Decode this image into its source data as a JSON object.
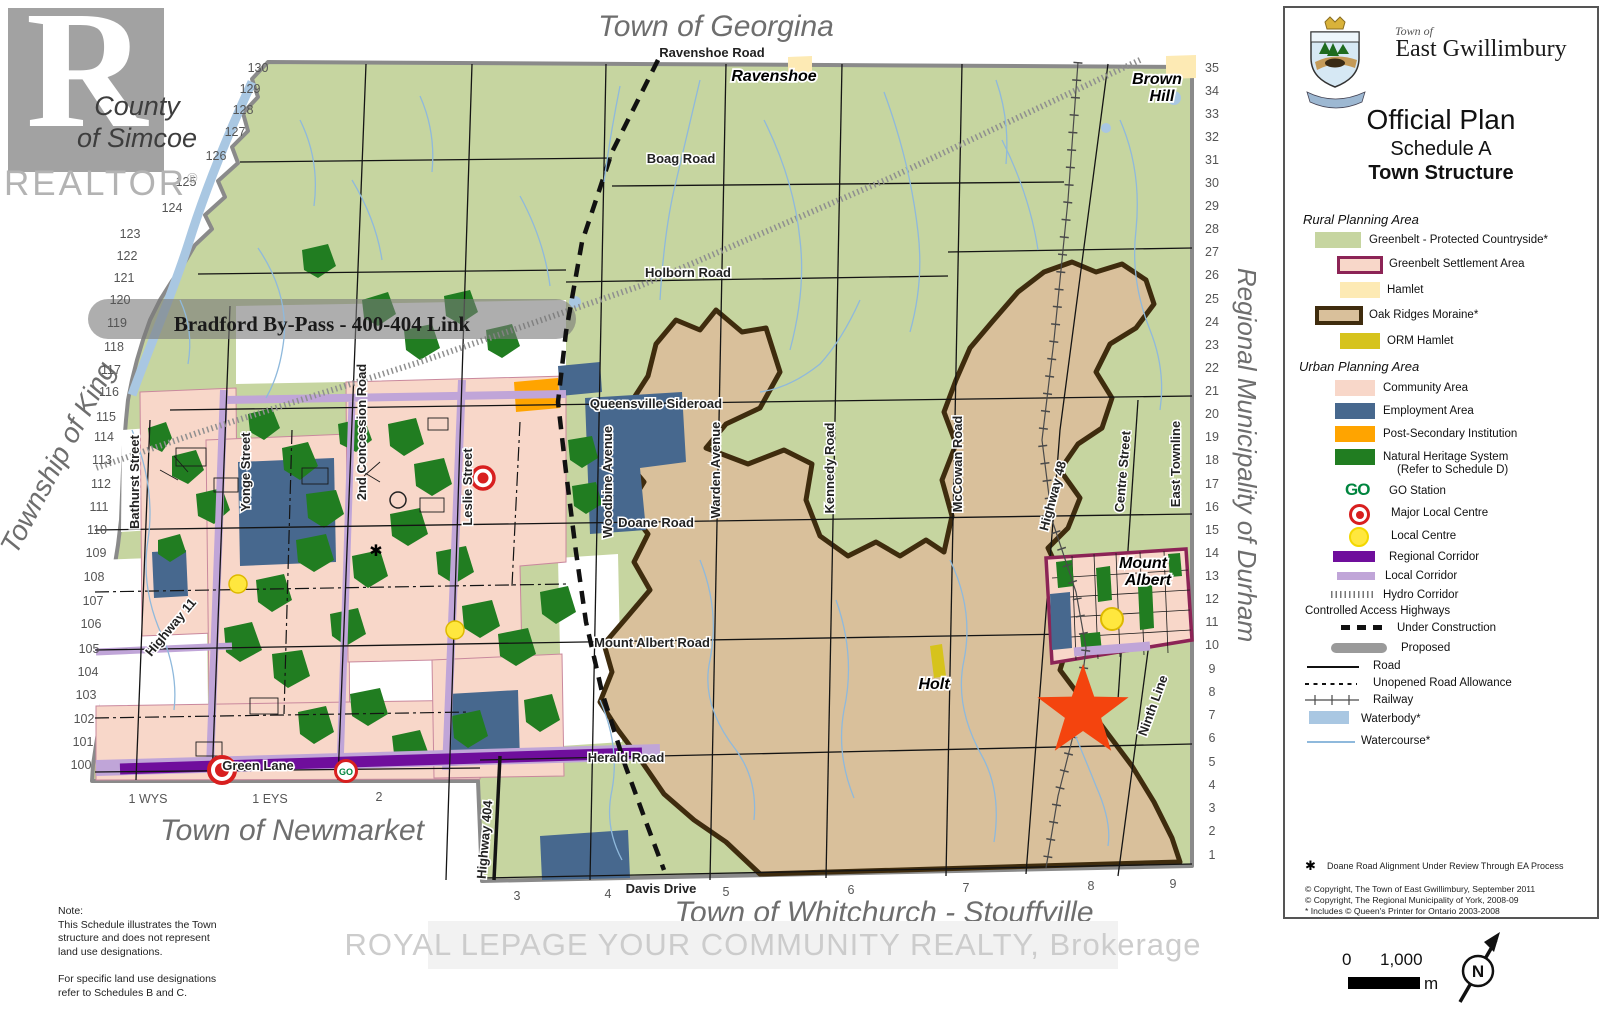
{
  "watermarks": {
    "r_letter": "R",
    "county_line1": "County",
    "county_line2": "of Simcoe",
    "realtor": "REALTOR",
    "registered": "®",
    "brokerage": "ROYAL LEPAGE YOUR COMMUNITY REALTY, Brokerage"
  },
  "title_block": {
    "town_of": "Town of",
    "town_name": "East Gwillimbury",
    "plan": "Official Plan",
    "schedule": "Schedule A",
    "structure": "Town Structure"
  },
  "legend": {
    "rural_header": "Rural Planning Area",
    "rural": [
      {
        "label": "Greenbelt - Protected Countryside*"
      },
      {
        "label": "Greenbelt Settlement Area"
      },
      {
        "label": "Hamlet"
      },
      {
        "label": "Oak Ridges Moraine*"
      },
      {
        "label": "ORM Hamlet"
      }
    ],
    "urban_header": "Urban Planning Area",
    "urban": [
      {
        "label": "Community Area"
      },
      {
        "label": "Employment Area"
      },
      {
        "label": "Post-Secondary Institution"
      },
      {
        "label": "Natural Heritage System",
        "label2": "(Refer to Schedule D)"
      }
    ],
    "symbols": {
      "go_text": "GO",
      "go_station": "GO Station",
      "major": "Major Local Centre",
      "local": "Local Centre",
      "regional_corridor": "Regional Corridor",
      "local_corridor": "Local Corridor",
      "hydro": "Hydro Corridor",
      "cah_header": "Controlled Access Highways",
      "under_construction": "Under Construction",
      "proposed": "Proposed",
      "road": "Road",
      "unopened": "Unopened Road Allowance",
      "railway": "Railway",
      "waterbody": "Waterbody*",
      "watercourse": "Watercourse*"
    },
    "footnote_star": "✱",
    "footnote": "Doane Road Alignment Under Review Through EA Process",
    "copyright1": "© Copyright, The Town of East Gwillimbury, September 2011",
    "copyright2": "© Copyright, The Regional Municipality of York, 2008-09",
    "copyright3": "* Includes © Queen's Printer for Ontario 2003-2008"
  },
  "notes": {
    "text": "Note:\nThis Schedule illustrates the Town\nstructure and does not represent\nland use designations.\n\nFor specific land use designations\nrefer to Schedules B and C."
  },
  "scale": {
    "zero": "0",
    "distance": "1,000",
    "unit": "m",
    "north": "N"
  },
  "colors": {
    "greenbelt": "#c6d5a0",
    "orm": "#d9c09b",
    "community": "#f8d7c9",
    "employment": "#47688e",
    "post_secondary": "#ffa400",
    "nhs": "#217d21",
    "hamlet": "#fdeab4",
    "orm_hamlet": "#d6c31c",
    "regional_corridor": "#6f0e9c",
    "local_corridor": "#c0a5d8",
    "waterbody": "#a9c7e2",
    "go_green": "#00853f",
    "centre_red": "#d81f1f",
    "local_yellow": "#ffe73e",
    "star": "#f4440e"
  },
  "map_labels": [
    {
      "t": "Town of Georgina",
      "x": 716,
      "y": 36,
      "r": 0,
      "c": "muni"
    },
    {
      "t": "Township of King",
      "x": 66,
      "y": 462,
      "r": -62,
      "c": "muni muni-k"
    },
    {
      "t": "Regional Municipality of Durham",
      "x": 1238,
      "y": 455,
      "r": 90,
      "c": "muni muni-v"
    },
    {
      "t": "Town of Newmarket",
      "x": 292,
      "y": 840,
      "r": 0,
      "c": "muni"
    },
    {
      "t": "Town of Whitchurch - Stouffville",
      "x": 884,
      "y": 922,
      "r": 0,
      "c": "muni"
    },
    {
      "t": "Ravenshoe Road",
      "x": 712,
      "y": 57,
      "r": 0,
      "c": "road-h"
    },
    {
      "t": "Boag Road",
      "x": 681,
      "y": 163,
      "r": 0,
      "c": "road-h"
    },
    {
      "t": "Holborn Road",
      "x": 688,
      "y": 277,
      "r": 0,
      "c": "road-h"
    },
    {
      "t": "Queensville Sideroad",
      "x": 656,
      "y": 408,
      "r": 0,
      "c": "road-h"
    },
    {
      "t": "Doane Road",
      "x": 656,
      "y": 527,
      "r": 0,
      "c": "road-h"
    },
    {
      "t": "Mount Albert Road",
      "x": 652,
      "y": 647,
      "r": 0,
      "c": "road-h"
    },
    {
      "t": "Herald Road",
      "x": 626,
      "y": 762,
      "r": 0,
      "c": "road-h"
    },
    {
      "t": "Green Lane",
      "x": 258,
      "y": 770,
      "r": 0,
      "c": "road-h"
    },
    {
      "t": "Davis Drive",
      "x": 661,
      "y": 893,
      "r": 0,
      "c": "road-h"
    },
    {
      "t": "Bathurst Street",
      "x": 139,
      "y": 482,
      "r": -90,
      "c": "road-v"
    },
    {
      "t": "Yonge Street",
      "x": 250,
      "y": 472,
      "r": -90,
      "c": "road-v"
    },
    {
      "t": "2nd Concession Road",
      "x": 366,
      "y": 432,
      "r": -90,
      "c": "road-v"
    },
    {
      "t": "Leslie Street",
      "x": 472,
      "y": 487,
      "r": -90,
      "c": "road-v"
    },
    {
      "t": "Woodbine Avenue",
      "x": 612,
      "y": 482,
      "r": -90,
      "c": "road-v"
    },
    {
      "t": "Warden Avenue",
      "x": 720,
      "y": 470,
      "r": -90,
      "c": "road-v"
    },
    {
      "t": "Kennedy Road",
      "x": 834,
      "y": 468,
      "r": -90,
      "c": "road-v"
    },
    {
      "t": "McCowan Road",
      "x": 962,
      "y": 464,
      "r": -90,
      "c": "road-v"
    },
    {
      "t": "Highway 48",
      "x": 1057,
      "y": 497,
      "r": -75,
      "c": "road-v"
    },
    {
      "t": "Centre Street",
      "x": 1127,
      "y": 472,
      "r": -85,
      "c": "road-v"
    },
    {
      "t": "East Townline",
      "x": 1180,
      "y": 464,
      "r": -90,
      "c": "road-v"
    },
    {
      "t": "Ninth Line",
      "x": 1157,
      "y": 707,
      "r": -70,
      "c": "road-v"
    },
    {
      "t": "Highway 404",
      "x": 489,
      "y": 840,
      "r": -85,
      "c": "road-v"
    },
    {
      "t": "Highway 11",
      "x": 174,
      "y": 630,
      "r": -50,
      "c": "road-v"
    },
    {
      "t": "Ravenshoe",
      "x": 774,
      "y": 81,
      "r": 0,
      "c": "place"
    },
    {
      "t": "Brown",
      "x": 1157,
      "y": 84,
      "r": 0,
      "c": "place"
    },
    {
      "t": "Hill",
      "x": 1162,
      "y": 101,
      "r": 0,
      "c": "place"
    },
    {
      "t": "Mount",
      "x": 1143,
      "y": 568,
      "r": 0,
      "c": "place"
    },
    {
      "t": "Albert",
      "x": 1148,
      "y": 585,
      "r": 0,
      "c": "place"
    },
    {
      "t": "Holt",
      "x": 934,
      "y": 689,
      "r": 0,
      "c": "place"
    },
    {
      "t": "Bradford By-Pass - 400-404 Link",
      "x": 322,
      "y": 331,
      "r": 0,
      "c": "bypass"
    }
  ],
  "edge_numbers": {
    "left": [
      [
        130,
        258,
        72
      ],
      [
        129,
        250,
        93
      ],
      [
        128,
        243,
        114
      ],
      [
        127,
        235,
        136
      ],
      [
        126,
        216,
        160
      ],
      [
        125,
        186,
        186
      ],
      [
        124,
        172,
        212
      ],
      [
        123,
        130,
        238
      ],
      [
        122,
        127,
        260
      ],
      [
        121,
        124,
        282
      ],
      [
        120,
        120,
        304
      ],
      [
        119,
        117,
        327
      ],
      [
        118,
        114,
        351
      ],
      [
        117,
        111,
        374
      ],
      [
        116,
        109,
        396
      ],
      [
        115,
        106,
        421
      ],
      [
        114,
        104,
        441
      ],
      [
        113,
        102,
        464
      ],
      [
        112,
        101,
        488
      ],
      [
        111,
        99,
        511
      ],
      [
        110,
        97,
        534
      ],
      [
        109,
        96,
        557
      ],
      [
        108,
        94,
        581
      ],
      [
        107,
        93,
        605
      ],
      [
        106,
        91,
        628
      ],
      [
        105,
        89,
        653
      ],
      [
        104,
        88,
        676
      ],
      [
        103,
        86,
        699
      ],
      [
        102,
        84,
        723
      ],
      [
        101,
        83,
        746
      ],
      [
        100,
        81,
        769
      ]
    ],
    "right": [
      [
        35,
        1212,
        72
      ],
      [
        34,
        1212,
        95
      ],
      [
        33,
        1212,
        118
      ],
      [
        32,
        1212,
        141
      ],
      [
        31,
        1212,
        164
      ],
      [
        30,
        1212,
        187
      ],
      [
        29,
        1212,
        210
      ],
      [
        28,
        1212,
        233
      ],
      [
        27,
        1212,
        256
      ],
      [
        26,
        1212,
        279
      ],
      [
        25,
        1212,
        303
      ],
      [
        24,
        1212,
        326
      ],
      [
        23,
        1212,
        349
      ],
      [
        22,
        1212,
        372
      ],
      [
        21,
        1212,
        395
      ],
      [
        20,
        1212,
        418
      ],
      [
        19,
        1212,
        441
      ],
      [
        18,
        1212,
        464
      ],
      [
        17,
        1212,
        488
      ],
      [
        16,
        1212,
        511
      ],
      [
        15,
        1212,
        534
      ],
      [
        14,
        1212,
        557
      ],
      [
        13,
        1212,
        580
      ],
      [
        12,
        1212,
        603
      ],
      [
        11,
        1212,
        626
      ],
      [
        10,
        1212,
        649
      ],
      [
        9,
        1212,
        673
      ],
      [
        8,
        1212,
        696
      ],
      [
        7,
        1212,
        719
      ],
      [
        6,
        1212,
        742
      ],
      [
        5,
        1212,
        766
      ],
      [
        4,
        1212,
        789
      ],
      [
        3,
        1212,
        812
      ],
      [
        2,
        1212,
        835
      ],
      [
        1,
        1212,
        859
      ]
    ],
    "bottom": [
      [
        "1 WYS",
        148,
        803
      ],
      [
        "1 EYS",
        270,
        803
      ],
      [
        "2",
        379,
        801
      ],
      [
        "3",
        517,
        900
      ],
      [
        "4",
        608,
        898
      ],
      [
        "5",
        726,
        896
      ],
      [
        "6",
        851,
        894
      ],
      [
        "7",
        966,
        892
      ],
      [
        "8",
        1091,
        890
      ],
      [
        "9",
        1173,
        888
      ]
    ]
  }
}
